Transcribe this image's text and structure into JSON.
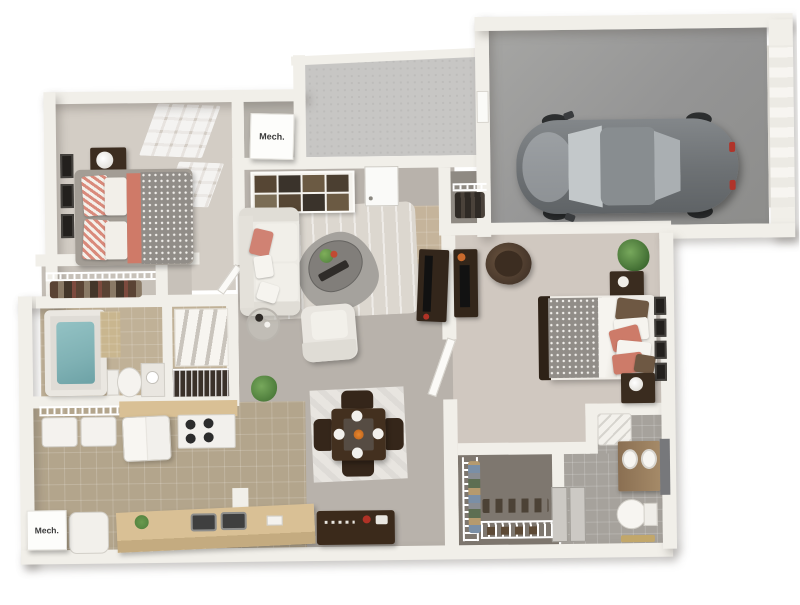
{
  "scene": {
    "type": "3d-floor-plan-rendering",
    "subject": "two-bedroom apartment with attached one-car garage",
    "rooms": [
      "bedroom-1",
      "bedroom-1-closet",
      "bathroom-1",
      "linen-shelves",
      "living-room",
      "entry",
      "dining-area",
      "kitchen",
      "laundry-shelves",
      "mechanical-closet-upper",
      "mechanical-closet-lower",
      "patio",
      "garage",
      "coat-closet",
      "bedroom-2",
      "walk-in-closet",
      "bathroom-2"
    ],
    "furniture": [
      "bed",
      "nightstand",
      "lamp",
      "picture-frames",
      "sofa",
      "armchair",
      "coffee-table",
      "side-table",
      "cubby-shelf",
      "tv-console",
      "dining-table",
      "dining-chairs",
      "buffet",
      "refrigerator",
      "range",
      "kitchen-sink",
      "bathtub",
      "toilet",
      "vanity",
      "washer-dryer",
      "papasan-chair",
      "dresser",
      "plant",
      "car",
      "area-rugs"
    ]
  },
  "labels": {
    "mech_upper": "Mech.",
    "mech_lower": "Mech."
  },
  "palette": {
    "background": "#ffffff",
    "wall": "#f1efe9",
    "carpet_bedroom": "#d2ccc4",
    "great_room_floor": "#b8b2ab",
    "tile_kitchen": "#b3a58c",
    "tile_bath1": "#c0b197",
    "tile_entry": "#c5b49b",
    "tile_bath2": "#a6a29c",
    "garage_floor": "#9c9c9c",
    "patio_concrete": "#c7c6c4",
    "accent_coral": "#cd7b69",
    "wood_dark": "#3a2c1f",
    "counter_tan": "#d9c095",
    "bathtub_water_teal": "#7fb1b4",
    "car_gray": "#6d7174",
    "plant_green": "#5a8f4a"
  }
}
